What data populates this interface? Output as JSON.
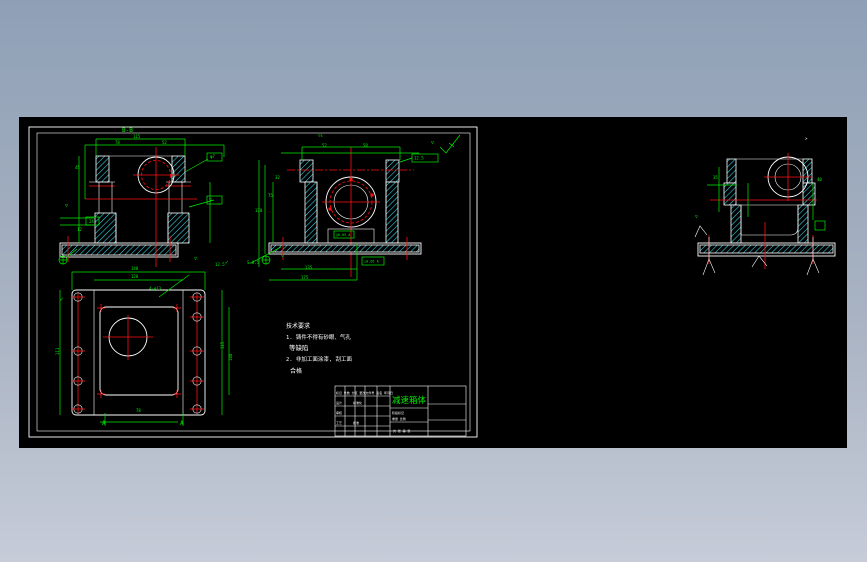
{
  "window": {
    "background_top": "#8fa0b6",
    "background_bottom": "#c6ccd8",
    "canvas_color": "#000000"
  },
  "colors": {
    "outline": "#ffffff",
    "dimension": "#00ee00",
    "centerline": "#ff1111",
    "hatch": "#3bdcf0"
  },
  "drawing": {
    "title_block": {
      "title": "减速箱体"
    },
    "notes": [
      "技术要求",
      "1. 铸件不得有砂眼、气孔",
      "等缺陷",
      "2. 非加工面涂漆, 刮工面",
      "合格"
    ],
    "labels": [
      {
        "x": 103,
        "y": 15,
        "t": "B-B",
        "s": 6
      },
      {
        "x": 114,
        "y": 21,
        "t": "115",
        "s": 4
      },
      {
        "x": 96,
        "y": 27,
        "t": "78",
        "s": 4
      },
      {
        "x": 143,
        "y": 27,
        "t": "52",
        "s": 4
      },
      {
        "x": 56,
        "y": 52,
        "t": "45",
        "s": 4
      },
      {
        "x": 46,
        "y": 90,
        "t": "▽",
        "s": 5
      },
      {
        "x": 70,
        "y": 106,
        "t": "24",
        "s": 4
      },
      {
        "x": 58,
        "y": 114,
        "t": "12",
        "s": 4
      },
      {
        "x": 191,
        "y": 41,
        "t": "φ7",
        "s": 4
      },
      {
        "x": 190,
        "y": 84,
        "t": "▽",
        "s": 5
      },
      {
        "x": 175,
        "y": 143,
        "t": "▽",
        "s": 5
      },
      {
        "x": 299,
        "y": 20,
        "t": "▽s",
        "s": 4
      },
      {
        "x": 303,
        "y": 30,
        "t": "52",
        "s": 4
      },
      {
        "x": 344,
        "y": 30,
        "t": "58",
        "s": 4
      },
      {
        "x": 236,
        "y": 95,
        "t": "170",
        "s": 4
      },
      {
        "x": 249,
        "y": 80,
        "t": "75",
        "s": 4
      },
      {
        "x": 256,
        "y": 62,
        "t": "32",
        "s": 4
      },
      {
        "x": 395,
        "y": 42.5,
        "t": "12.5",
        "s": 4
      },
      {
        "x": 412,
        "y": 27,
        "t": "▽",
        "s": 5
      },
      {
        "x": 317,
        "y": 119,
        "t": "∥0.05 A",
        "s": 3.5
      },
      {
        "x": 345,
        "y": 145.5,
        "t": "⊥0.05 A",
        "s": 3.5
      },
      {
        "x": 286,
        "y": 152,
        "t": "135",
        "s": 4
      },
      {
        "x": 282,
        "y": 162,
        "t": "175",
        "s": 4
      },
      {
        "x": 228,
        "y": 147,
        "t": "S=0.5",
        "s": 4
      },
      {
        "x": 262,
        "y": 140,
        "t": "▽",
        "s": 5
      },
      {
        "x": 112,
        "y": 153,
        "t": "148",
        "s": 4
      },
      {
        "x": 112,
        "y": 161,
        "t": "128",
        "s": 4
      },
      {
        "x": 196,
        "y": 149,
        "t": "12.5",
        "s": 4
      },
      {
        "x": 206,
        "y": 147,
        "t": "✓",
        "s": 6
      },
      {
        "x": 130,
        "y": 173,
        "t": "4-φ13",
        "s": 4
      },
      {
        "x": 40,
        "y": 238,
        "t": "111",
        "s": 4,
        "r": -90
      },
      {
        "x": 205,
        "y": 232,
        "t": "115",
        "s": 4,
        "r": -90
      },
      {
        "x": 213,
        "y": 244,
        "t": "148",
        "s": 4,
        "r": -90
      },
      {
        "x": 117,
        "y": 295,
        "t": "78",
        "s": 4
      },
      {
        "x": 83,
        "y": 308,
        "t": "A",
        "s": 6
      },
      {
        "x": 161,
        "y": 308,
        "t": "A",
        "s": 6
      },
      {
        "x": 41,
        "y": 184,
        "t": "✓",
        "s": 6
      },
      {
        "x": 694,
        "y": 62,
        "t": "35",
        "s": 4
      },
      {
        "x": 798,
        "y": 64,
        "t": "40",
        "s": 4
      },
      {
        "x": 786,
        "y": 23,
        "t": ">",
        "s": 4,
        "c": "#ffffff"
      },
      {
        "x": 676,
        "y": 101,
        "t": "▽",
        "s": 5
      },
      {
        "x": 317,
        "y": 277,
        "t": "标记 处数 分区 更改文件号 签名 年月日",
        "s": 3,
        "c": "#ffffff"
      },
      {
        "x": 317,
        "y": 287,
        "t": "设计",
        "s": 3,
        "c": "#ffffff"
      },
      {
        "x": 334,
        "y": 287,
        "t": "标准化",
        "s": 3,
        "c": "#ffffff"
      },
      {
        "x": 317,
        "y": 297,
        "t": "审核",
        "s": 3,
        "c": "#ffffff"
      },
      {
        "x": 317,
        "y": 307,
        "t": "工艺",
        "s": 3,
        "c": "#ffffff"
      },
      {
        "x": 334,
        "y": 307,
        "t": "批准",
        "s": 3,
        "c": "#ffffff"
      },
      {
        "x": 373,
        "y": 297,
        "t": "阶段标记",
        "s": 3,
        "c": "#ffffff"
      },
      {
        "x": 373,
        "y": 303,
        "t": "重量 比例",
        "s": 3,
        "c": "#ffffff"
      },
      {
        "x": 374,
        "y": 315,
        "t": "共 张 第 张",
        "s": 3,
        "c": "#ffffff"
      }
    ]
  }
}
